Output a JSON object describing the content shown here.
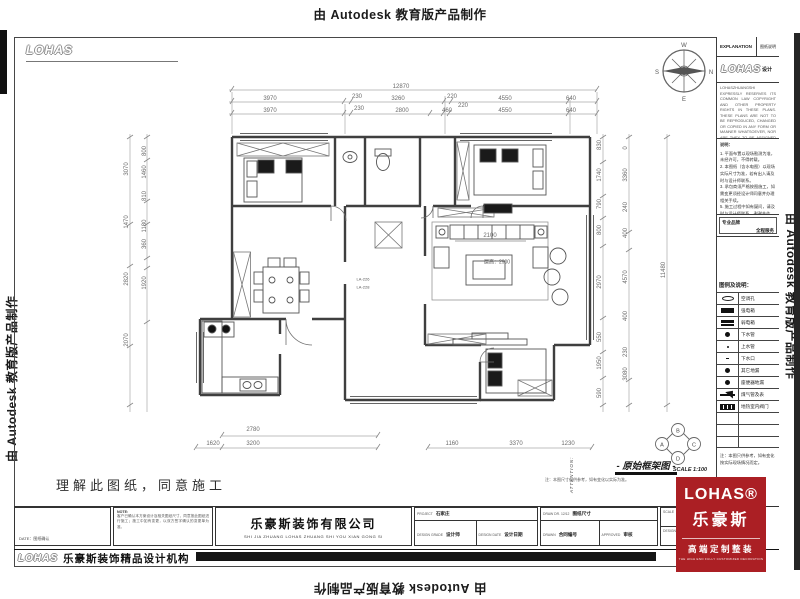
{
  "banner": {
    "top": "由 Autodesk 教育版产品制作",
    "left": "由 Autodesk 教育版产品制作",
    "right": "由 Autodesk 教育版产品制作",
    "bottom": "由 Autodesk 教育版产品制作"
  },
  "sheet": {
    "corner_logo": "LOHAS",
    "footer_logo": "LOHAS",
    "footer_brand": "乐豪斯装饰精品设计机构",
    "confirm_text": "理解此图纸，同意施工"
  },
  "panel": {
    "header_left": "EXPLANATION",
    "header_right": "图纸说明",
    "logo": "LOHAS",
    "logo_suffix": "设计",
    "copyright": "LOHASZHUANGSHI EXPRESSLY RESERVES ITS COMMON LAW COPYRIGHT AND OTHER PROPERTY RIGHTS IN THESE PLANS. THESE PLANS ARE NOT TO BE REPRODUCED, CHANGED OR COPIED IN ANY FORM OR MANNER WHATSOEVER, NOR ARE THEY TO BE ASSIGNED TO ANY THIRD PARTY WITHOUT FIRST OBTAINING THE EXPRESSED WRITTEN PERMISSION AND CONSENT OF LOHASZHUANGSHI.",
    "notes_title": "说明：",
    "notes": [
      "1. 平面布置以现场勘测为准，未经许可，不得转载。",
      "2. 本图纸（含水电图）以现场实际尺寸为准，若有出入请及时与设计师联系。",
      "3. 承包商须严格按图施工，如需变更须经设计师同意并办理相关手续。",
      "5. 施工过程中如有疑问，请及时与设计师联系，谢谢合作。"
    ],
    "brand_left": "专业品牌",
    "brand_right": "全程服务",
    "legend_title": "图例及说明：",
    "legend": [
      {
        "sym": "sym-oval",
        "label": "空调孔"
      },
      {
        "sym": "sym-solid",
        "label": "强电箱"
      },
      {
        "sym": "sym-slot",
        "label": "弱电箱"
      },
      {
        "sym": "sym-dot-lg",
        "label": "下水管"
      },
      {
        "sym": "sym-dot-sm",
        "label": "上水管"
      },
      {
        "sym": "sym-dash",
        "label": "下水口"
      },
      {
        "sym": "sym-dot-lg",
        "label": "其它地漏"
      },
      {
        "sym": "sym-dot-lg",
        "label": "座便器地漏"
      },
      {
        "sym": "sym-gas",
        "label": "煤气管及表"
      },
      {
        "sym": "sym-valve",
        "label": "地热室内阀门"
      }
    ],
    "legend_note": "注：本图只供参考，如有变化按实际现场情况而定。"
  },
  "plan": {
    "title": "- 原始框架图 -",
    "scale": "SCALE 1:100",
    "title_note": "注：本图尺寸仅供参考，如有变化以实际为准。",
    "attention": "ATTENTION:",
    "ceiling": "层高：2900",
    "labels": [
      "LA-226",
      "LA-228"
    ],
    "compass": {
      "top": "W",
      "right": "N",
      "left": "S",
      "bottom": "E"
    },
    "elev_index": {
      "top": "B",
      "left": "A",
      "right": "C",
      "bottom": "D"
    },
    "dims": {
      "top_total": "12870",
      "top_row2": [
        "3970",
        "230",
        "3260",
        "220",
        "4550",
        "640"
      ],
      "top_row3": [
        "3970",
        "230",
        "2800",
        "460",
        "220",
        "4550",
        "640"
      ],
      "left_outer": [
        "3070",
        "1470",
        "2820",
        "2070"
      ],
      "left_inner": [
        "800",
        "1460",
        "810",
        "1180",
        "360",
        "1920"
      ],
      "right_inner": [
        "830",
        "1740",
        "790",
        "800",
        "2970",
        "550",
        "1950",
        "590"
      ],
      "right_mid": [
        "0",
        "3360",
        "240",
        "400",
        "4570",
        "400",
        "230",
        "3080"
      ],
      "right_outer": "11480",
      "bottom": [
        "1620",
        "2780",
        "3200",
        "1160",
        "3370",
        "1230"
      ],
      "sofa": "2100"
    }
  },
  "titleblock": {
    "date_note": "DATE：图纸确认",
    "note_label": "NOTE:",
    "note_text": "客户已确认本方案设计及相关图纸尺寸，同意按此图纸进行施工；施工中如有变更，以双方签字确认的变更单为准。",
    "company": "乐豪斯装饰有限公司",
    "company_en": "SHI JIA ZHUANG  LOHAS ZHUANG SHI YOU XIAN GONG SI",
    "project_label": "PROJECT",
    "project_value": "石家庄",
    "fields_a": [
      {
        "label": "DESIGN GRADE",
        "value": "设计师"
      },
      {
        "label": "DESIGN DATE",
        "value": "设计日期"
      }
    ],
    "draw_label": "DRAW DR. 12/12",
    "draw_value": "图纸尺寸",
    "fields_b": [
      {
        "label": "DRAWN",
        "value": "合同编号"
      },
      {
        "label": "APPROVED",
        "value": "审核"
      }
    ],
    "fields_c": [
      "SCALE",
      "DESIGNED"
    ]
  },
  "red_logo": {
    "brand": "LOHAS®",
    "brand_cn": "乐豪斯",
    "tagline": "高端定制整装",
    "tagline_en": "THE HIGH END FULLY CUSTOMIZED DECORATION",
    "color": "#ab1f24"
  }
}
